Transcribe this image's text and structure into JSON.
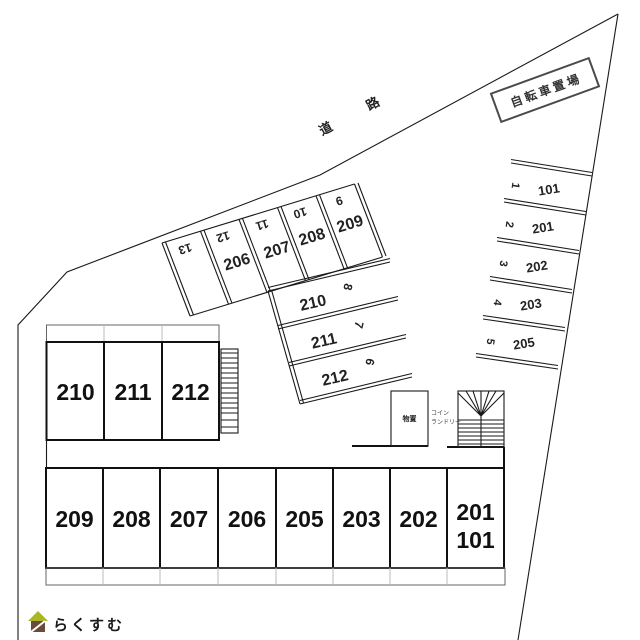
{
  "labels": {
    "road": {
      "char1": "道",
      "char2": "路"
    },
    "bicycle_parking": "自転車置場",
    "storage": "物置",
    "coin_laundry": {
      "line1": "コイン",
      "line2": "ランドリー"
    },
    "logo": "らくすむ"
  },
  "right_parking": {
    "stalls": [
      {
        "no": "1",
        "unit": "101"
      },
      {
        "no": "2",
        "unit": "201"
      },
      {
        "no": "3",
        "unit": "202"
      },
      {
        "no": "4",
        "unit": "203"
      },
      {
        "no": "5",
        "unit": "205"
      }
    ]
  },
  "diagonal_parking": {
    "stalls": [
      {
        "no": "13",
        "unit": ""
      },
      {
        "no": "12",
        "unit": "206"
      },
      {
        "no": "11",
        "unit": "207"
      },
      {
        "no": "10",
        "unit": "208"
      },
      {
        "no": "9",
        "unit": "209"
      }
    ]
  },
  "row_parking": {
    "stalls": [
      {
        "no": "8",
        "unit": "210"
      },
      {
        "no": "7",
        "unit": "211"
      },
      {
        "no": "6",
        "unit": "212"
      }
    ]
  },
  "upper_building": {
    "rooms": [
      "210",
      "211",
      "212"
    ]
  },
  "lower_building": {
    "rooms": [
      "209",
      "208",
      "207",
      "206",
      "205",
      "203",
      "202"
    ],
    "corner_room": {
      "line1": "201",
      "line2": "101"
    }
  },
  "colors": {
    "line": "#1a1a1a",
    "light_line": "#bbbbbb",
    "logo_text": "#95867b",
    "logo_roof": "#a9b822",
    "logo_house": "#6a4b3b"
  }
}
